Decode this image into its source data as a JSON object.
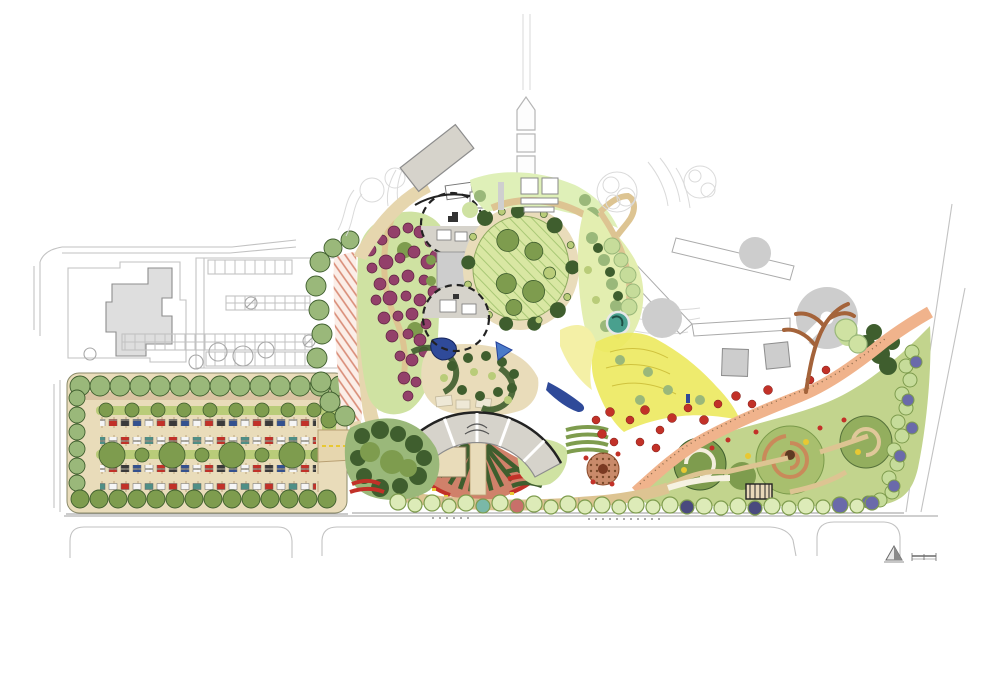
{
  "plan": {
    "type": "landscape-master-plan",
    "media_style": "hand-rendered watercolor site plan",
    "markers": {
      "north_arrow_icon": "triangle-north-arrow",
      "scale_bar_icon": "graphic-scale-bar"
    }
  },
  "features": [
    {
      "id": "existing-campus",
      "label": "existing buildings and streets (uncolored linework)"
    },
    {
      "id": "existing-parking",
      "label": "existing parking field with stall striping"
    },
    {
      "id": "new-parking-lot",
      "label": "tree-lined parking lot with parked cars"
    },
    {
      "id": "entry-drive",
      "label": "curved arrival drive"
    },
    {
      "id": "visitor-center",
      "label": "angled gray entry building"
    },
    {
      "id": "arrival-plaza",
      "label": "dashed circular arrival plaza"
    },
    {
      "id": "central-walk",
      "label": "gray axial walk between plazas"
    },
    {
      "id": "event-lawn",
      "label": "oval event lawn ringed by path and trees"
    },
    {
      "id": "orchard-garden",
      "label": "purple flowering orchard grove"
    },
    {
      "id": "courtyard-gardens",
      "label": "courtyard gardens with hedges and water"
    },
    {
      "id": "fan-display-garden",
      "label": "fan-shaped display beds with arc pavilion"
    },
    {
      "id": "wildflower-meadow",
      "label": "yellow wildflower meadow"
    },
    {
      "id": "salmon-promenade",
      "label": "winding salmon-colored garden path"
    },
    {
      "id": "themed-garden-rooms",
      "label": "southeast themed garden rooms"
    },
    {
      "id": "future-phase",
      "label": "uncolored future phase with gray tree canopies"
    },
    {
      "id": "keyhole-pavilion",
      "label": "round pavilion roof with radial notch"
    },
    {
      "id": "street-frontage",
      "label": "perimeter streets and curb returns"
    }
  ],
  "palette": {
    "paper": "#ffffff",
    "ink": "#222222",
    "line_exist": "#c2c2c2",
    "line_soft": "#dadada",
    "bldg_stroke": "#8d8d8d",
    "exist_bldg": "#dedede",
    "future_gray": "#cdcdcd",
    "roof_gray": "#d6d3cb",
    "tan_paving": "#e9dcba",
    "tan_path": "#ddc492",
    "tan_drive": "#e6d6ae",
    "lawn": "#d9e7a3",
    "lawn_hatch": "#a9c876",
    "green_dark": "#3f5e2e",
    "green_mid": "#7e9c4e",
    "green_sage": "#9ab87a",
    "green_pale": "#cfe2a2",
    "green_lime": "#b9cc79",
    "hedge_pale": "#c6dc9a",
    "meadow": "#ece95e",
    "meadow_pale": "#f4f0a6",
    "purple": "#93406a",
    "purple_dark": "#5e2242",
    "red": "#c23128",
    "salmon": "#f0b38c",
    "salmon_deep": "#cd7a62",
    "yellow": "#e8c832",
    "teal": "#49a08e",
    "blue": "#2f4a99",
    "blue_violet": "#6a6aaa",
    "brown": "#a4633a",
    "brown_bed": "#c98a6a",
    "stall_tick": "#bda57f",
    "car_white": "#f5f5f5",
    "car_dark": "#3a3a3a",
    "car_blue": "#33518f",
    "car_teal": "#4f8f86"
  }
}
